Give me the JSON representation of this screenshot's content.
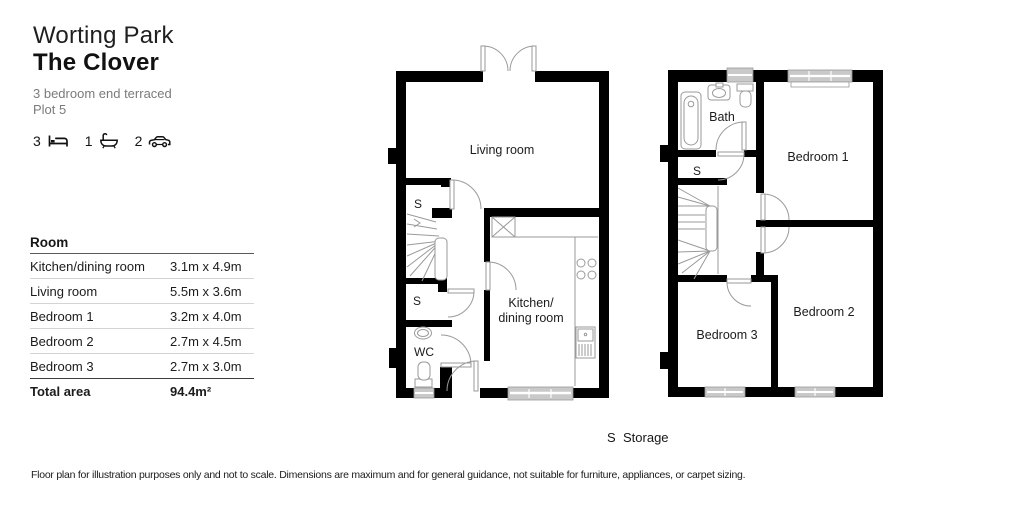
{
  "header": {
    "development": "Worting Park",
    "house": "The Clover",
    "description": "3 bedroom end terraced",
    "plot": "Plot 5"
  },
  "stats": {
    "beds": "3",
    "baths": "1",
    "cars": "2"
  },
  "table": {
    "header": "Room",
    "rows": [
      {
        "name": "Kitchen/dining room",
        "dims": "3.1m x 4.9m"
      },
      {
        "name": "Living room",
        "dims": "5.5m x 3.6m"
      },
      {
        "name": "Bedroom 1",
        "dims": "3.2m x 4.0m"
      },
      {
        "name": "Bedroom 2",
        "dims": "2.7m x 4.5m"
      },
      {
        "name": "Bedroom 3",
        "dims": "2.7m x 3.0m"
      }
    ],
    "total_label": "Total area",
    "total_value": "94.4m²"
  },
  "plans": {
    "ground": {
      "living": "Living room",
      "kitchen_line1": "Kitchen/",
      "kitchen_line2": "dining room",
      "storage1": "S",
      "storage2": "S",
      "wc": "WC"
    },
    "first": {
      "bath": "Bath",
      "storage": "S",
      "bedroom1": "Bedroom 1",
      "bedroom2": "Bedroom 2",
      "bedroom3": "Bedroom 3"
    }
  },
  "legend": {
    "symbol": "S",
    "label": "Storage"
  },
  "footer": {
    "disclaimer": "Floor plan for illustration purposes only and not to scale. Dimensions are maximum and for general guidance, not suitable for furniture, appliances, or carpet sizing."
  },
  "colors": {
    "wall": "#000000",
    "fixture_line": "#9a9a9a",
    "window_fill": "#c9c9c9",
    "muted_text": "#7b7b7b"
  }
}
